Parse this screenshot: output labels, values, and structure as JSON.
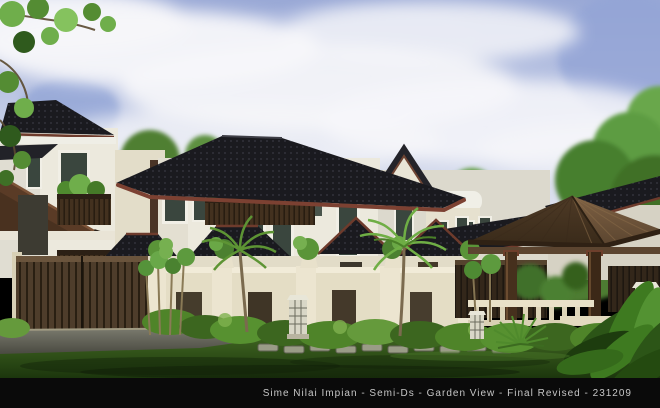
{
  "window": {
    "width": 660,
    "height": 408
  },
  "caption": {
    "full_text": "Sime Nilai Impian - Semi-Ds - Garden View - Final Revised - 231209",
    "project": "Sime Nilai Impian",
    "unit_type": "Semi-Ds",
    "view_name": "Garden View",
    "revision": "Final Revised",
    "date_code": "231209"
  },
  "scene": {
    "type": "architectural-exterior-rendering",
    "subject": "Two-storey semi-detached houses with dark tiled roofs, timber entrance gates, boundary wall with planter pots, timber gazebo and landscaped tropical garden",
    "elements": [
      "sky",
      "clouds",
      "trees",
      "semi-detached-houses",
      "dark-tile-roofs",
      "maroon-fascia",
      "balconies",
      "bay-window",
      "timber-gate",
      "boundary-wall",
      "planter-pots",
      "gazebo",
      "garden-hedges",
      "palm-trees",
      "lawn",
      "driveway",
      "stone-lattice-lamps",
      "foreground-plant"
    ]
  },
  "colors": {
    "bar": "#0a0a0a",
    "caption": "#c6c6c6",
    "sky-top": "#9aa9d6",
    "sky-bottom": "#e9ebf2",
    "roof": "#1b1b1f",
    "fascia": "#7c4132",
    "wall-cream": "#e9e3cf",
    "wood-dark": "#46311d",
    "gazebo-roof": "#6f5438",
    "grass": "#2f4f16",
    "hedge": "#4f8429",
    "drive": "#5f5f55"
  }
}
